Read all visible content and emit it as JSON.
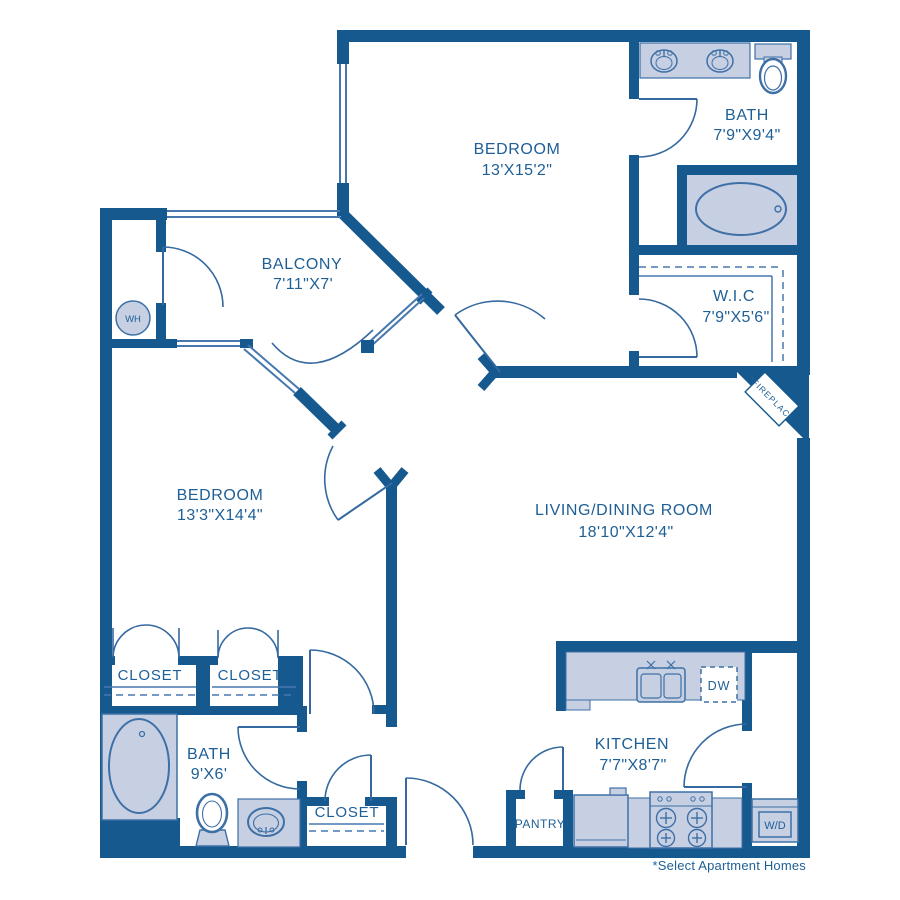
{
  "title": "Two bedroom apartment floor plan",
  "colors": {
    "wall": "#15598e",
    "fixture_fill": "#c7cfe3",
    "fixture_stroke": "#3e70a6",
    "door_line": "#35699f",
    "text": "#1e5f96",
    "background": "#ffffff"
  },
  "rooms": {
    "bedroom1": {
      "name": "BEDROOM",
      "dims": "13'X15'2\""
    },
    "bath1": {
      "name": "BATH",
      "dims": "7'9\"X9'4\""
    },
    "balcony": {
      "name": "BALCONY",
      "dims": "7'11\"X7'"
    },
    "wic": {
      "name": "W.I.C",
      "dims": "7'9\"X5'6\""
    },
    "bedroom2": {
      "name": "BEDROOM",
      "dims": "13'3\"X14'4\""
    },
    "living": {
      "name": "LIVING/DINING ROOM",
      "dims": "18'10\"X12'4\""
    },
    "kitchen": {
      "name": "KITCHEN",
      "dims": "7'7\"X8'7\""
    },
    "bath2": {
      "name": "BATH",
      "dims": "9'X6'"
    },
    "closet1": {
      "name": "CLOSET"
    },
    "closet2": {
      "name": "CLOSET"
    },
    "closet3": {
      "name": "CLOSET"
    },
    "pantry": {
      "name": "PANTRY"
    }
  },
  "labels": {
    "water_heater": "WH",
    "dishwasher": "DW",
    "washer_dryer": "W/D",
    "fireplace": "*FIREPLACE",
    "footnote": "*Select Apartment Homes"
  }
}
